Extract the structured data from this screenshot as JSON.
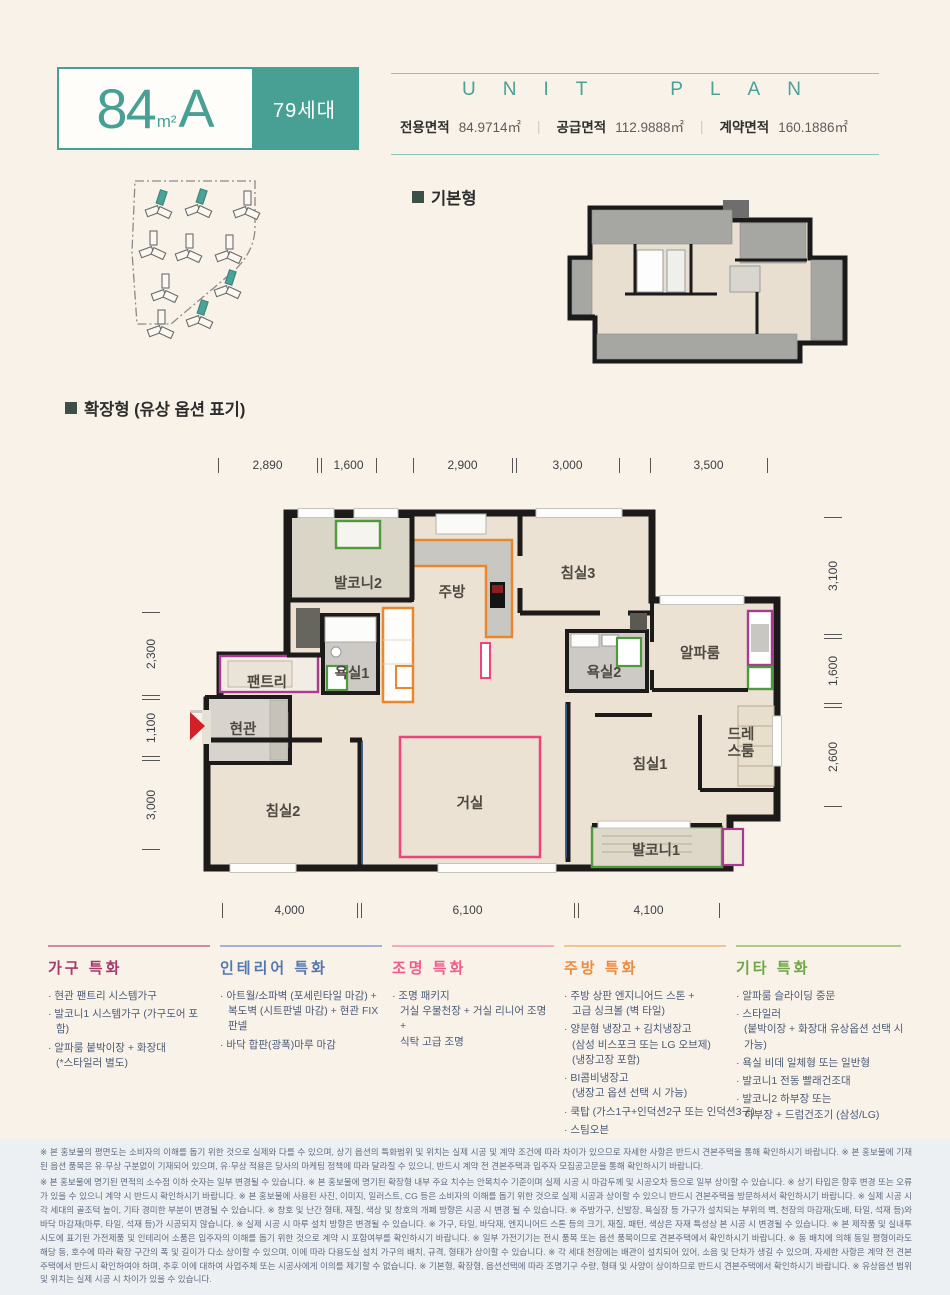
{
  "colors": {
    "accent_teal": "#47a093",
    "page_bg": "#f9f2e9",
    "option_orange": "#e8872e",
    "option_pink": "#f2417b",
    "option_green": "#4f9a3e",
    "option_purple": "#a93a8f",
    "entry_arrow_red": "#d41f26"
  },
  "header": {
    "size": "84",
    "size_unit": "m²",
    "type": "A",
    "badge": "79세대",
    "unit_plan": "UNIT PLAN",
    "divider": "|",
    "areas": [
      {
        "label": "전용면적",
        "value": "84.9714㎡"
      },
      {
        "label": "공급면적",
        "value": "112.9888㎡"
      },
      {
        "label": "계약면적",
        "value": "160.1886㎡"
      }
    ]
  },
  "sections": {
    "basic_label": "기본형",
    "extended_label": "확장형 (유상 옵션 표기)"
  },
  "floorplan": {
    "rooms": [
      "발코니2",
      "주방",
      "침실3",
      "욕실1",
      "팬트리",
      "현관",
      "욕실2",
      "알파룸",
      "침실2",
      "거실",
      "침실1",
      "발코니1"
    ],
    "dressroom": [
      "드레",
      "스룸"
    ],
    "dims_top": [
      "2,890",
      "1,600",
      "2,900",
      "3,000",
      "3,500"
    ],
    "dims_bottom": [
      "4,000",
      "6,100",
      "4,100"
    ],
    "dims_left": [
      "2,300",
      "1,100",
      "3,000"
    ],
    "dims_right": [
      "3,100",
      "1,600",
      "2,600"
    ]
  },
  "features": [
    {
      "title": "가구 특화",
      "color": "#a8386a",
      "line_color": "#cf8ba4",
      "items": [
        "현관 팬트리 시스템가구",
        "발코니1 시스템가구 (가구도어 포함)",
        "알파룸 붙박이장 + 화장대\n(*스타일러 별도)"
      ]
    },
    {
      "title": "인테리어 특화",
      "color": "#5577b0",
      "line_color": "#9db4d6",
      "items": [
        "아트월/소파벽 (포세린타일 마감) +\n복도벽 (시트판넬 마감) + 현관 FIX 판넬",
        "바닥 합판(광폭)마루 마감"
      ]
    },
    {
      "title": "조명 특화",
      "color": "#f25c8d",
      "line_color": "#f4aac1",
      "items": [
        "조명 패키지\n거실 우물천장 + 거실 리니어 조명 +\n식탁 고급 조명"
      ]
    },
    {
      "title": "주방 특화",
      "color": "#ec8b3e",
      "line_color": "#f2c492",
      "items": [
        "주방 상판 엔지니어드 스톤 +\n고급 싱크볼 (벽 타일)",
        "양문형 냉장고 + 김치냉장고\n(삼성 비스포크 또는 LG 오브제)\n(냉장고장 포함)",
        "BI콤비냉장고\n(냉장고 옵션 선택 시 가능)",
        "쿡탑 (가스1구+인덕션2구 또는 인덕션3구)",
        "스팀오븐"
      ]
    },
    {
      "title": "기타 특화",
      "color": "#6fa648",
      "line_color": "#abcb8d",
      "items": [
        "알파룸 슬라이딩 중문",
        "스타일러\n(붙박이장 + 화장대 유상옵션 선택 시 가능)",
        "욕실 비데 일체형 또는 일반형",
        "발코니1 전동 빨래건조대",
        "발코니2 하부장 또는\n하부장 + 드럼건조기 (삼성/LG)"
      ]
    }
  ],
  "disclaimer": {
    "p1": "※ 본 홍보물의 평면도는 소비자의 이해를 돕기 위한 것으로 실제와 다를 수 있으며, 상기 옵션의 특화범위 및 위치는 실제 시공 및 계약 조건에 따라 차이가 있으므로 자세한 사항은 반드시 견본주택을 통해 확인하시기 바랍니다. ※ 본 홍보물에 기재된 옵션 품목은 유·무상 구분없이 기재되어 있으며, 유·무상 적용은 당사의 마케팅 정책에 따라 달라질 수 있으니, 반드시 계약 전 견본주택과 입주자 모집공고문을 통해 확인하시기 바랍니다.",
    "p2": "※ 본 홍보물에 명기된 면적의 소수점 이하 숫자는 일부 변경될 수 있습니다. ※ 본 홍보물에 명기된 확장형 내부 주요 치수는 안목치수 기준이며 실제 시공 시 마감두께 및 시공오차 등으로 일부 상이할 수 있습니다. ※ 상기 타입은 향후 변경 또는 오류가 있을 수 있으니 계약 시 반드시 확인하시기 바랍니다. ※ 본 홍보물에 사용된 사진, 이미지, 일러스트, CG 등은 소비자의 이해를 돕기 위한 것으로 실제 시공과 상이할 수 있으니 반드시 견본주택을 방문하셔서 확인하시기 바랍니다. ※ 실제 시공 시 각 세대의 골조턱 높이, 기타 경미한 부분이 변경될 수 있습니다. ※ 창호 및 난간 형태, 재질, 색상 및 창호의 개폐 방향은 시공 시 변경 될 수 있습니다. ※ 주방가구, 신발장, 욕실장 등 가구가 설치되는 부위의 벽, 천장의 마감재(도배, 타일, 석재 등)와 바닥 마감재(마루, 타일, 석재 등)가 시공되지 않습니다. ※ 실제 시공 시 마루 설치 방향은 변경될 수 있습니다. ※ 가구, 타일, 바닥재, 엔지니어드 스톤 등의 크기, 재질, 패턴, 색상은 자재 특성상 본 시공 시 변경될 수 있습니다. ※ 본 제작품 및 실내투시도에 표기된 가전제품 및 인테리어 소품은 입주자의 이해를 돕기 위한 것으로 계약 시 포함여부를 확인하시기 바랍니다. ※ 일부 가전기기는 전시 품목 또는 옵션 품목이므로 견본주택에서 확인하시기 바랍니다. ※ 동 배치에 의해 동일 평형이라도 해당 동, 호수에 따라 확장 구간의 폭 및 길이가 다소 상이할 수 있으며, 이에 따라 다용도실 설치 가구의 배치, 규격, 형태가 상이할 수 있습니다. ※ 각 세대 천장에는 배관이 설치되어 있어, 소음 및 단차가 생길 수 있으며, 자세한 사항은 계약 전 견본주택에서 반드시 확인하여야 하며, 추후 이에 대하여 사업주체 또는 시공사에게 이의를 제기할 수 없습니다. ※ 기본형, 확장형, 옵션선택에 따라 조명기구 수량, 형태 및 사양이 상이하므로 반드시 견본주택에서 확인하시기 바랍니다. ※ 유상옵션 범위 및 위치는 실제 시공 시 차이가 있을 수 있습니다."
  }
}
